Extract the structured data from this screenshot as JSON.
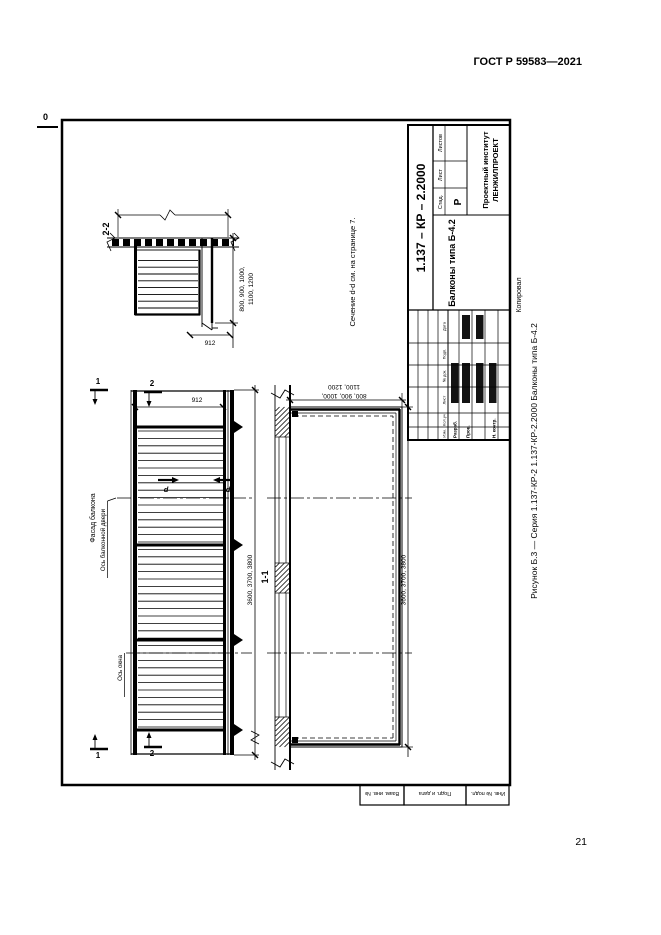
{
  "page": {
    "header_code": "ГОСТ Р 59583—2021",
    "page_number": "21",
    "corner_mark": "0",
    "caption": "Рисунок Б.3 — Серия 1.137-КР-2 1.137-КР-2.2000 Балконы типа Б-4.2"
  },
  "drawing": {
    "facade": {
      "title": "Фасад балкона",
      "door_axis_label": "Ось балконной двери",
      "window_axis_label": "Ось окна",
      "length_dim": "3600, 3700, 3800",
      "height_dim": "912",
      "cut_label_1": "1",
      "cut_label_2": "2",
      "section_label_d": "d"
    },
    "plan": {
      "title": "1-1",
      "length_dim": "3600, 3700, 3800",
      "depth_dim_line1": "800, 900, 1000,",
      "depth_dim_line2": "1100, 1200"
    },
    "section": {
      "title": "2-2",
      "width_dim_line1": "800, 900, 1000,",
      "width_dim_line2": "1100, 1200",
      "height_dim": "912"
    },
    "note": "Сечение d-d см. на странице 7."
  },
  "title_block": {
    "designation": "1.137 – КР – 2.2000",
    "doc_title": "Балконы типа Б-4.2",
    "stage_label": "Стад.",
    "sheet_label": "Лист",
    "sheets_label": "Листов",
    "stage_value": "Р",
    "org_line1": "Проектный институт",
    "org_line2": "ЛЕНЖИЛПРОЕКТ",
    "col_headers": [
      "Изм.",
      "Кол.уч",
      "Лист",
      "№ док.",
      "Подп.",
      "Дата"
    ],
    "row_labels": [
      "Разраб.",
      "Пров.",
      "Н. контр."
    ],
    "copied_label": "Копировал"
  },
  "margin_strip": {
    "cells": [
      "Взам. инв. №",
      "Подп. и дата",
      "Инв. № подл."
    ]
  }
}
